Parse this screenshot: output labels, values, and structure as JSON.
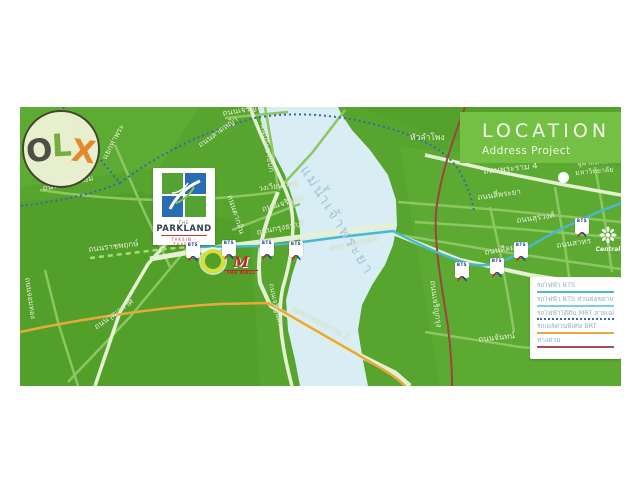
{
  "watermark": {
    "letters": [
      {
        "char": "O",
        "color": "#4e4f45"
      },
      {
        "char": "L",
        "color": "#76ad3f"
      },
      {
        "char": "X",
        "color": "#e2892e"
      }
    ]
  },
  "header": {
    "title": "LOCATION",
    "subtitle": "Address Project",
    "bg_color": "#74c044"
  },
  "project": {
    "brand_top": "THE",
    "brand": "PARKLAND",
    "brand_sub": "TAKSIN - THAPRA"
  },
  "markers": {
    "bts": "BTS",
    "mall_initial": "M",
    "mall": "THE MALL",
    "central": "Central"
  },
  "map": {
    "river_label": "แม่น้ำเจ้าพระยา",
    "road_labels": [
      "ถนนเจริญนคร",
      "ถนนลาดหญ้า",
      "ถนนประชาธิปก",
      "วงเวียนใหญ่",
      "ถนนเจริญรัถ",
      "ถนนกรุงธนบุรี",
      "ถนนตากสิน",
      "สะพานตากสิน",
      "ถนนเพชรเกษม",
      "แยกท่าพระ",
      "ถนนราชพฤกษ์",
      "ถนนจอมทอง",
      "ถนนวุฒากาศ",
      "สะพานพระราม 3",
      "ถนนเจริญนคร",
      "ถนนเจริญกรุง",
      "ถนนจันทน์",
      "ถนนสีลม",
      "ถนนสาทร",
      "ถนนสุรวงศ์",
      "ถนนพระราม 4",
      "ถนนสี่พระยา",
      "หัวลำโพง",
      "จุฬาลงกรณ์",
      "มหาวิทยาลัย"
    ]
  },
  "legend": {
    "items": [
      {
        "label": "รถไฟฟ้า BTS",
        "color": "#4fb6ce",
        "style": "solid"
      },
      {
        "label": "รถไฟฟ้า BTS ส่วนต่อขยาย",
        "color": "#7fcddd",
        "style": "solid"
      },
      {
        "label": "รถไฟฟ้าใต้ดิน MRT สายเฉลิมรัชมงคล",
        "color": "#3a67ad",
        "style": "dotted"
      },
      {
        "label": "รถเมล์ด่วนพิเศษ BRT",
        "color": "#e8a93c",
        "style": "solid"
      },
      {
        "label": "ทางด่วน",
        "color": "#a84b52",
        "style": "solid"
      }
    ]
  }
}
